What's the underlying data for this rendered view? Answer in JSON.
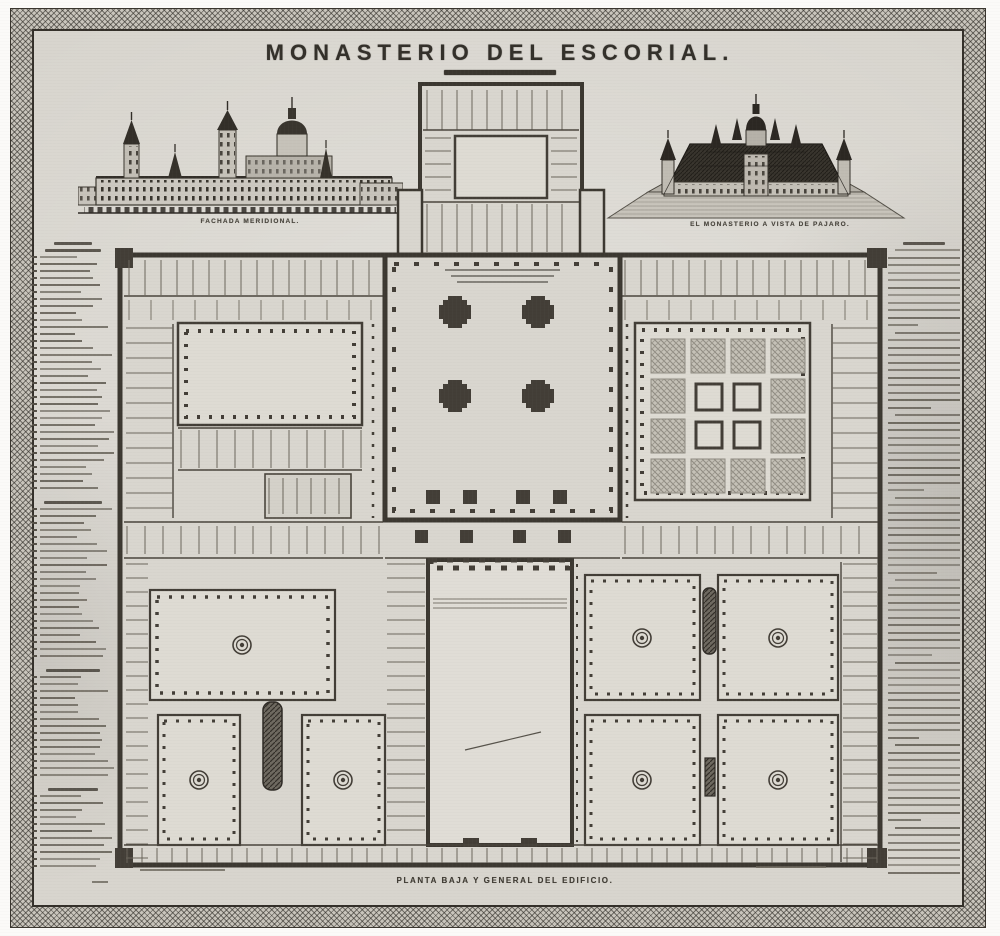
{
  "page": {
    "title": "MONASTERIO DEL ESCORIAL.",
    "kind": "19th-century engraved plate: plan and views of El Escorial"
  },
  "vignettes": {
    "south_facade": {
      "caption": "FACHADA MERIDIONAL."
    },
    "birds_eye": {
      "caption": "EL MONASTERIO A VISTA DE PAJARO."
    }
  },
  "plan": {
    "caption": "PLANTA BAJA Y GENERAL DEL EDIFICIO."
  },
  "legend_column": {
    "description": "numbered key, text too small to read in source",
    "sections": [
      {
        "header_lines": 2,
        "lines": 34
      },
      {
        "header_lines": 1,
        "lines": 22
      },
      {
        "header_lines": 1,
        "lines": 15
      },
      {
        "header_lines": 1,
        "lines": 11
      }
    ]
  },
  "notes_column": {
    "description": "historical note, justified prose, text too small to read in source",
    "header_lines": 1,
    "lines": 84,
    "paragraph_every": 11
  },
  "colors": {
    "paper": "#d8d5ce",
    "ink": "#33302a",
    "wall": "#433e37",
    "courtyard": "#dedbd3",
    "garden": "#c2beb4",
    "water": "#5a554d",
    "frame": "#c9c5bc"
  }
}
